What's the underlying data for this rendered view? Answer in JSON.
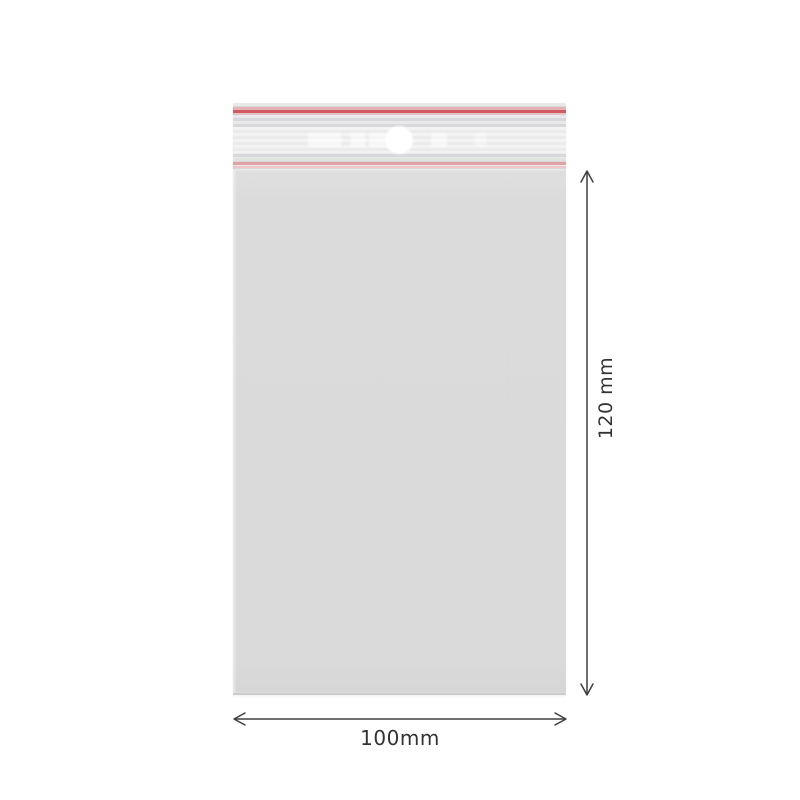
{
  "diagram": {
    "subject": "resealable-zip-bag-with-hang-hole",
    "dimensions": {
      "height": {
        "label": "120 mm"
      },
      "width": {
        "label": "100mm"
      }
    },
    "colors": {
      "background": "#ffffff",
      "bag_body": "#dadada",
      "zipper_red": "#ce5a62",
      "zipper_pink": "#e2a1a7",
      "zipper_pink_light": "#e5b3b7",
      "annotation": "#3f3f3f",
      "label_text": "#333333"
    },
    "icons": {
      "hang_hole": "white-circle"
    }
  }
}
